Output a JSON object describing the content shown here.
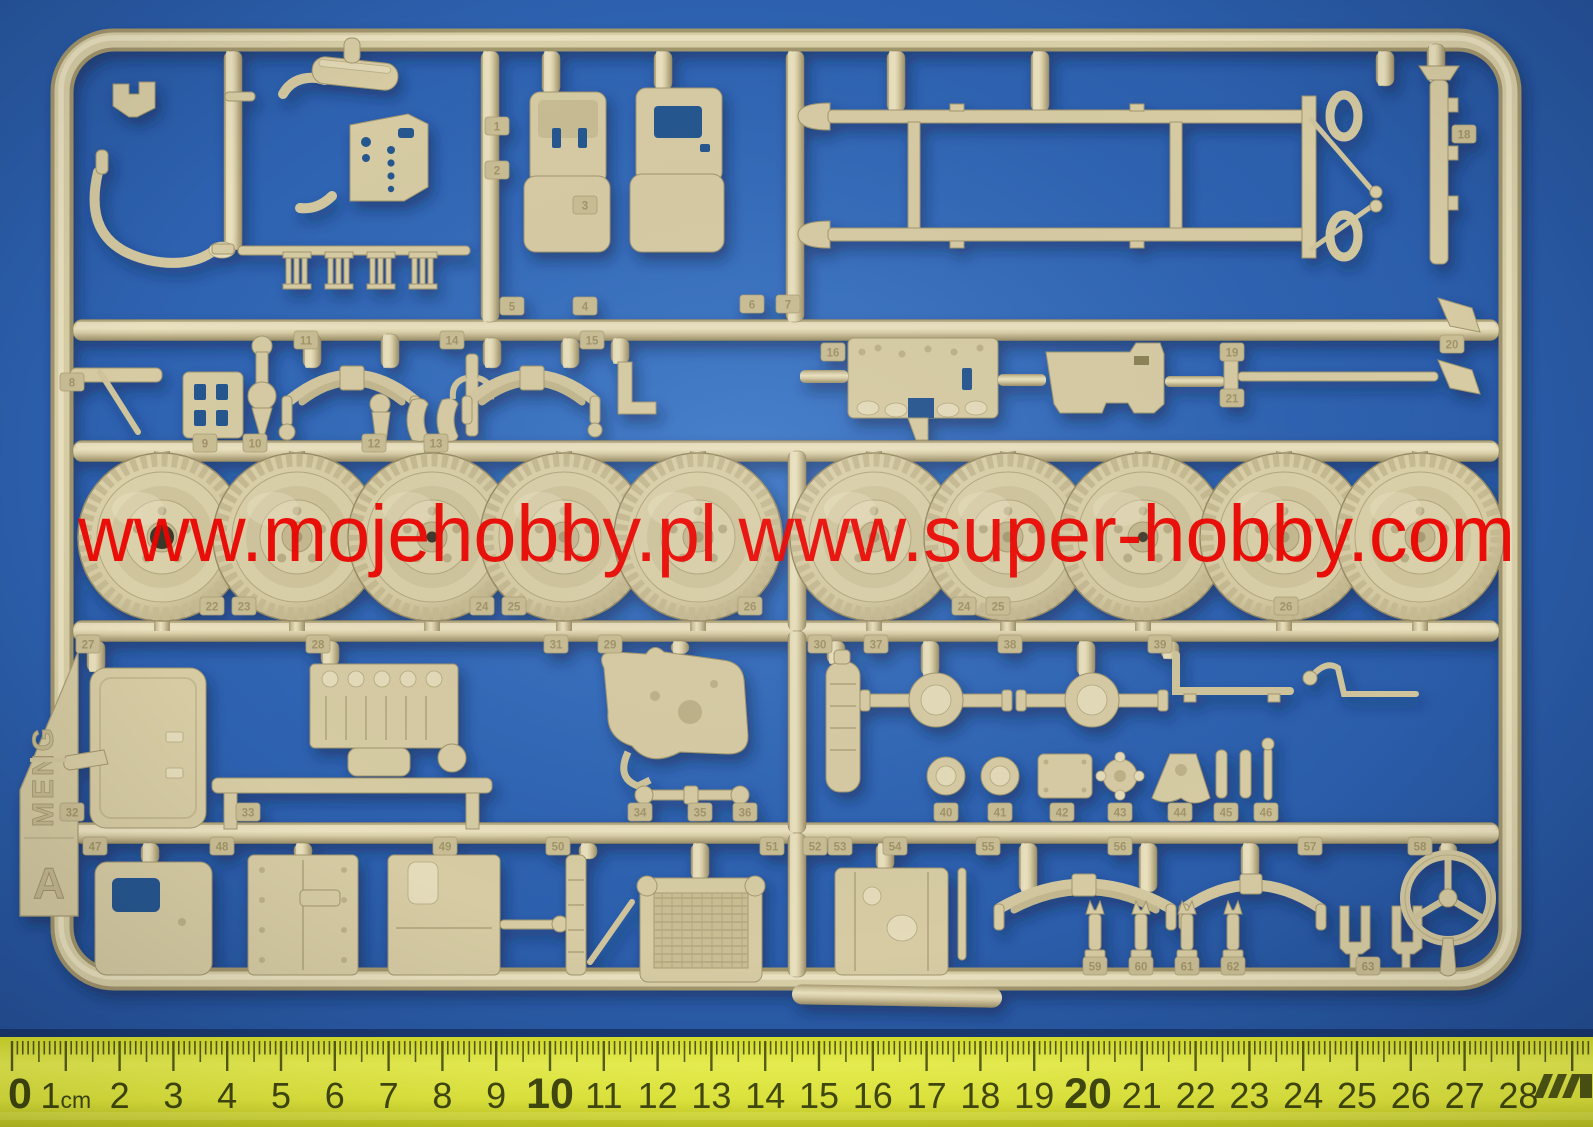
{
  "watermark": {
    "text": "www.mojehobby.pl www.super-hobby.com",
    "color": "#ed0400"
  },
  "sprue": {
    "brand": "MENG",
    "panel_letter": "A",
    "plastic_color": "#d6cba3",
    "wheels": {
      "count": 10
    },
    "part_tags": [
      {
        "n": "1",
        "x": 497,
        "y": 126
      },
      {
        "n": "2",
        "x": 497,
        "y": 170
      },
      {
        "n": "3",
        "x": 585,
        "y": 205
      },
      {
        "n": "4",
        "x": 585,
        "y": 306
      },
      {
        "n": "5",
        "x": 512,
        "y": 306
      },
      {
        "n": "6",
        "x": 752,
        "y": 304
      },
      {
        "n": "7",
        "x": 788,
        "y": 304
      },
      {
        "n": "8",
        "x": 72,
        "y": 382
      },
      {
        "n": "9",
        "x": 205,
        "y": 443
      },
      {
        "n": "10",
        "x": 255,
        "y": 443
      },
      {
        "n": "11",
        "x": 306,
        "y": 340
      },
      {
        "n": "12",
        "x": 374,
        "y": 443
      },
      {
        "n": "13",
        "x": 436,
        "y": 443
      },
      {
        "n": "14",
        "x": 452,
        "y": 340
      },
      {
        "n": "15",
        "x": 592,
        "y": 340
      },
      {
        "n": "16",
        "x": 833,
        "y": 352
      },
      {
        "n": "18",
        "x": 1464,
        "y": 134
      },
      {
        "n": "19",
        "x": 1232,
        "y": 352
      },
      {
        "n": "20",
        "x": 1452,
        "y": 344
      },
      {
        "n": "21",
        "x": 1232,
        "y": 398
      },
      {
        "n": "22",
        "x": 212,
        "y": 606
      },
      {
        "n": "23",
        "x": 244,
        "y": 606
      },
      {
        "n": "24",
        "x": 482,
        "y": 606
      },
      {
        "n": "25",
        "x": 514,
        "y": 606
      },
      {
        "n": "26",
        "x": 750,
        "y": 606
      },
      {
        "n": "24",
        "x": 964,
        "y": 606
      },
      {
        "n": "25",
        "x": 998,
        "y": 606
      },
      {
        "n": "26",
        "x": 1286,
        "y": 606
      },
      {
        "n": "27",
        "x": 88,
        "y": 644
      },
      {
        "n": "28",
        "x": 318,
        "y": 644
      },
      {
        "n": "31",
        "x": 556,
        "y": 644
      },
      {
        "n": "29",
        "x": 610,
        "y": 644
      },
      {
        "n": "30",
        "x": 820,
        "y": 644
      },
      {
        "n": "37",
        "x": 876,
        "y": 644
      },
      {
        "n": "38",
        "x": 1010,
        "y": 644
      },
      {
        "n": "39",
        "x": 1160,
        "y": 644
      },
      {
        "n": "32",
        "x": 72,
        "y": 812
      },
      {
        "n": "33",
        "x": 248,
        "y": 812
      },
      {
        "n": "34",
        "x": 640,
        "y": 812
      },
      {
        "n": "35",
        "x": 700,
        "y": 812
      },
      {
        "n": "36",
        "x": 745,
        "y": 812
      },
      {
        "n": "40",
        "x": 946,
        "y": 812
      },
      {
        "n": "41",
        "x": 1000,
        "y": 812
      },
      {
        "n": "42",
        "x": 1062,
        "y": 812
      },
      {
        "n": "43",
        "x": 1120,
        "y": 812
      },
      {
        "n": "44",
        "x": 1180,
        "y": 812
      },
      {
        "n": "45",
        "x": 1226,
        "y": 812
      },
      {
        "n": "46",
        "x": 1266,
        "y": 812
      },
      {
        "n": "47",
        "x": 95,
        "y": 846
      },
      {
        "n": "48",
        "x": 222,
        "y": 846
      },
      {
        "n": "49",
        "x": 445,
        "y": 846
      },
      {
        "n": "50",
        "x": 558,
        "y": 846
      },
      {
        "n": "51",
        "x": 772,
        "y": 846
      },
      {
        "n": "52",
        "x": 815,
        "y": 846
      },
      {
        "n": "53",
        "x": 840,
        "y": 846
      },
      {
        "n": "54",
        "x": 895,
        "y": 846
      },
      {
        "n": "55",
        "x": 988,
        "y": 846
      },
      {
        "n": "56",
        "x": 1120,
        "y": 846
      },
      {
        "n": "57",
        "x": 1310,
        "y": 846
      },
      {
        "n": "58",
        "x": 1420,
        "y": 846
      },
      {
        "n": "59",
        "x": 1095,
        "y": 966
      },
      {
        "n": "60",
        "x": 1141,
        "y": 966
      },
      {
        "n": "61",
        "x": 1187,
        "y": 966
      },
      {
        "n": "62",
        "x": 1233,
        "y": 966
      },
      {
        "n": "63",
        "x": 1368,
        "y": 966
      }
    ]
  },
  "ruler": {
    "unit_label": "cm",
    "start": 0,
    "end": 28,
    "emphasized": [
      0,
      10,
      20
    ],
    "face_color": "#e9f043",
    "mark_color": "#434b10"
  },
  "background_color": "#2e63b2"
}
